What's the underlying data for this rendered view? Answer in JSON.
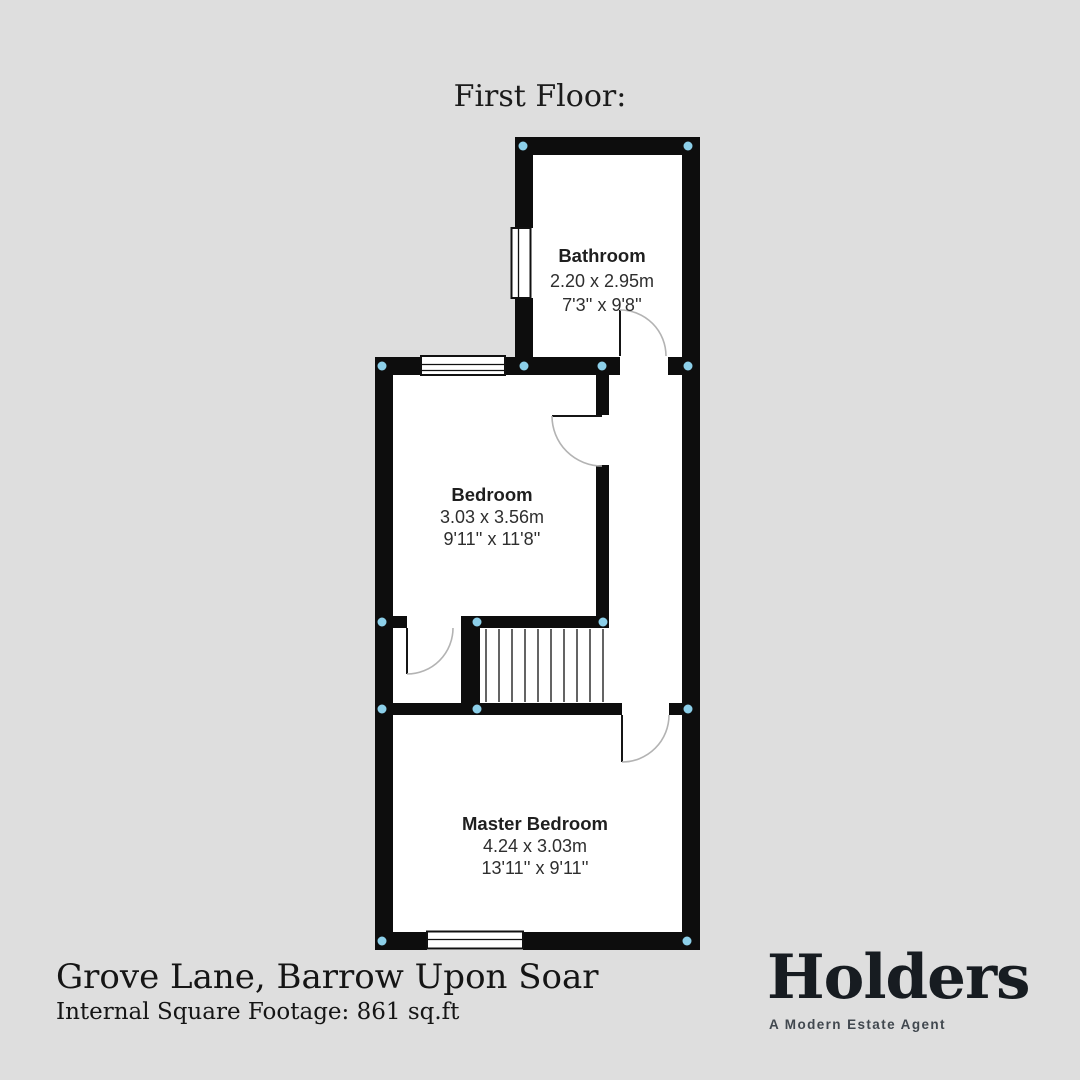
{
  "title": "First Floor:",
  "rooms": [
    {
      "name": "Bathroom",
      "metric": "2.20 x 2.95m",
      "imperial": "7'3'' x 9'8''"
    },
    {
      "name": "Bedroom",
      "metric": "3.03 x 3.56m",
      "imperial": "9'11'' x 11'8''"
    },
    {
      "name": "Master Bedroom",
      "metric": "4.24 x 3.03m",
      "imperial": "13'11'' x 9'11''"
    }
  ],
  "footer": {
    "address": "Grove Lane, Barrow Upon Soar",
    "square_footage": "Internal Square Footage: 861 sq.ft"
  },
  "brand": {
    "name": "Holders",
    "tagline": "A Modern Estate Agent"
  },
  "icons": {
    "corner_marker": "corner-marker-dot",
    "window": "window-symbol",
    "door": "door-swing-arc",
    "stairs": "stair-treads"
  },
  "colors": {
    "background": "#dedede",
    "wall": "#0d0d0d",
    "room": "#ffffff",
    "marker": "#8ccfe9",
    "arc": "#b3b3b3",
    "label": "#1f1f1f",
    "dim": "#2e2e2e",
    "footer-text": "#151515",
    "brand-text": "#171c21",
    "tagline-text": "#41484f"
  }
}
